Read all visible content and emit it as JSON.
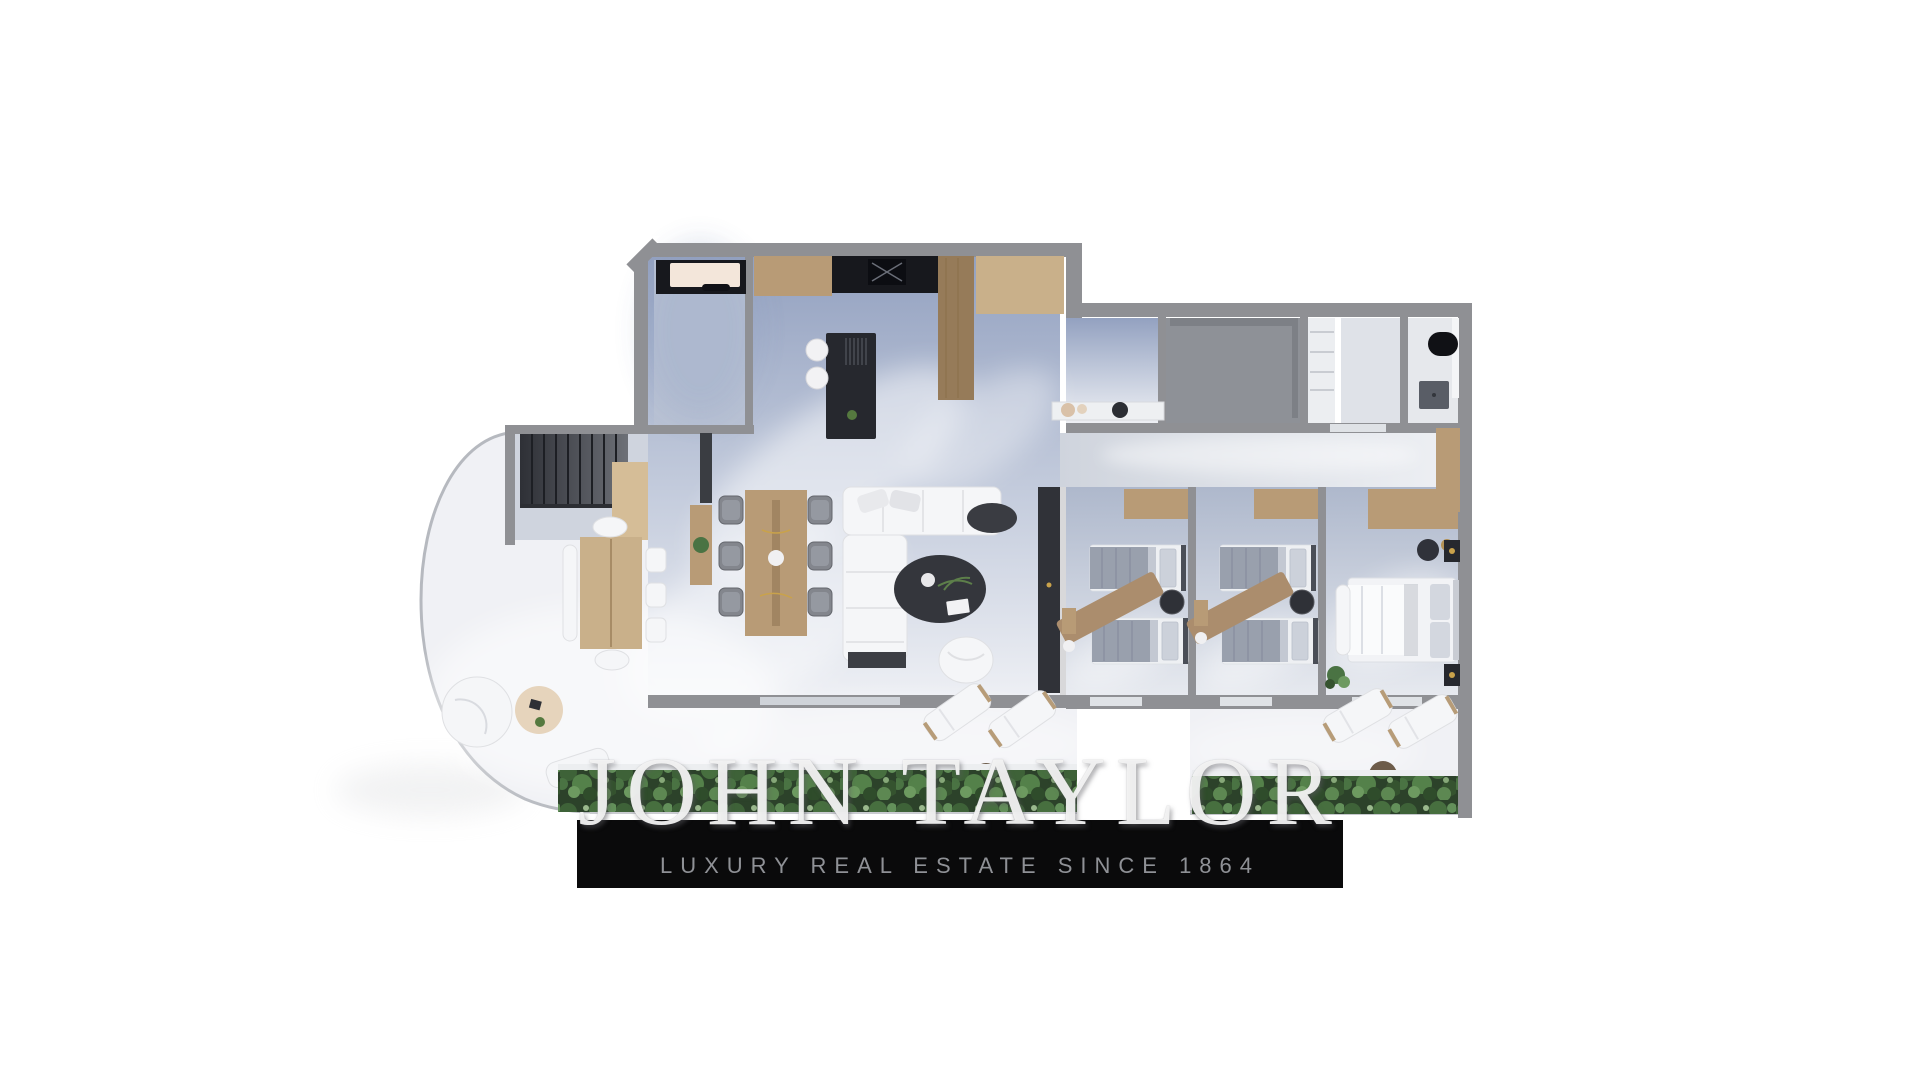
{
  "watermark": {
    "text": "JOHN TAYLOR"
  },
  "banner": {
    "tagline": "LUXURY REAL ESTATE SINCE 1864"
  },
  "colors": {
    "wall": "#8f9094",
    "wall-dark": "#6e6f73",
    "wood": "#b89b76",
    "wood-light": "#c9b08a",
    "wood-dark": "#967b59",
    "dark-furniture": "#26282e",
    "counter-black": "#17181d",
    "sofa-white": "#f5f6f8",
    "floor-blue": "#93a1c0",
    "floor-light": "#edeff4",
    "floor-gray": "#8e9197",
    "terrace": "#f0f1f5",
    "appliance": "#f3e6da",
    "bed-blanket": "#99a0ad",
    "throw": "#ab8d6d",
    "foliage-dark": "#2c422a",
    "foliage-mid": "#4a7343",
    "foliage-light": "#6d9a60",
    "band-bg": "#0a0a0b",
    "tagline": "#8f9196",
    "watermark": "rgba(246,246,246,0.92)"
  }
}
